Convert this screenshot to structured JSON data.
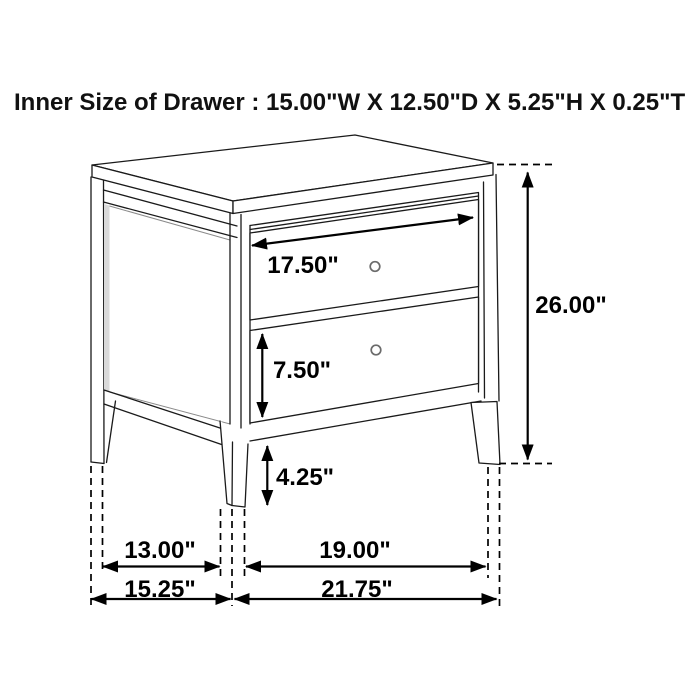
{
  "title": "Inner Size of Drawer : 15.00\"W X 12.50\"D X 5.25\"H X 0.25\"T",
  "dimensions": {
    "drawer_front_width": "17.50\"",
    "bottom_drawer_height": "7.50\"",
    "leg_height": "4.25\"",
    "overall_height": "26.00\"",
    "side_leg_spacing": "13.00\"",
    "overall_depth": "15.25\"",
    "front_leg_spacing": "19.00\"",
    "overall_width": "21.75\""
  },
  "colors": {
    "line_color": "#1a1a1a",
    "dimension_color": "#000000",
    "background": "#ffffff",
    "panel_shade": "#d9d9d9"
  }
}
